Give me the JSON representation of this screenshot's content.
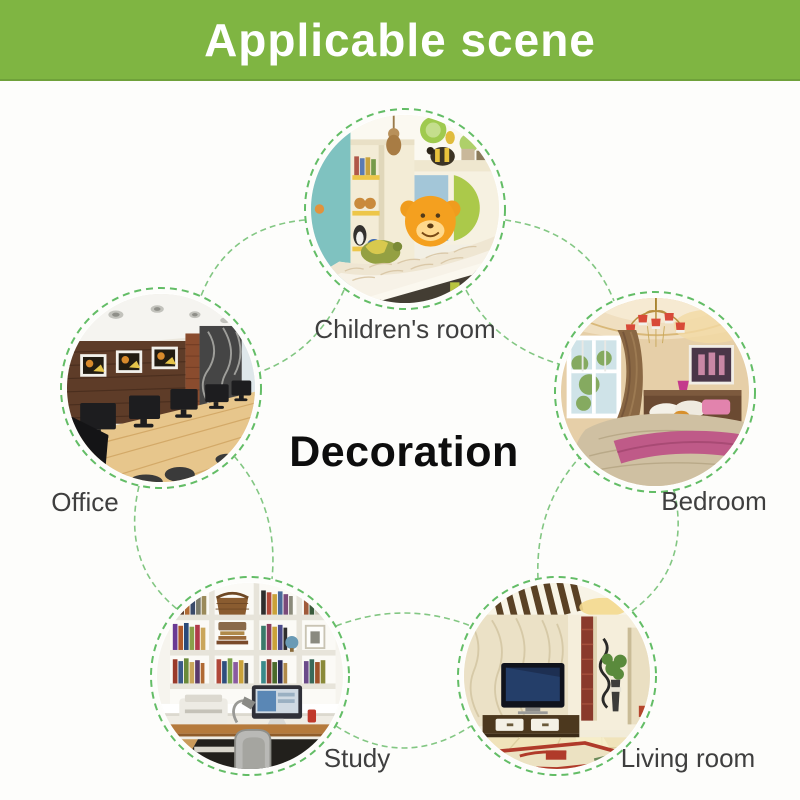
{
  "banner": {
    "title": "Applicable scene"
  },
  "center_label": "Decoration",
  "scenes": [
    {
      "id": "children-room",
      "label": "Children's room"
    },
    {
      "id": "office",
      "label": "Office"
    },
    {
      "id": "bedroom",
      "label": "Bedroom"
    },
    {
      "id": "study",
      "label": "Study"
    },
    {
      "id": "living-room",
      "label": "Living room"
    }
  ],
  "colors": {
    "banner_green": "#7fb542",
    "banner_border_green": "#6fa13a",
    "banner_text": "#ffffff",
    "ring_green": "#63bd66",
    "connector_green": "#7cc47c",
    "label_gray": "#3f3f3f",
    "center_text_black": "#0d0d0d",
    "background": "#fdfdfb"
  }
}
